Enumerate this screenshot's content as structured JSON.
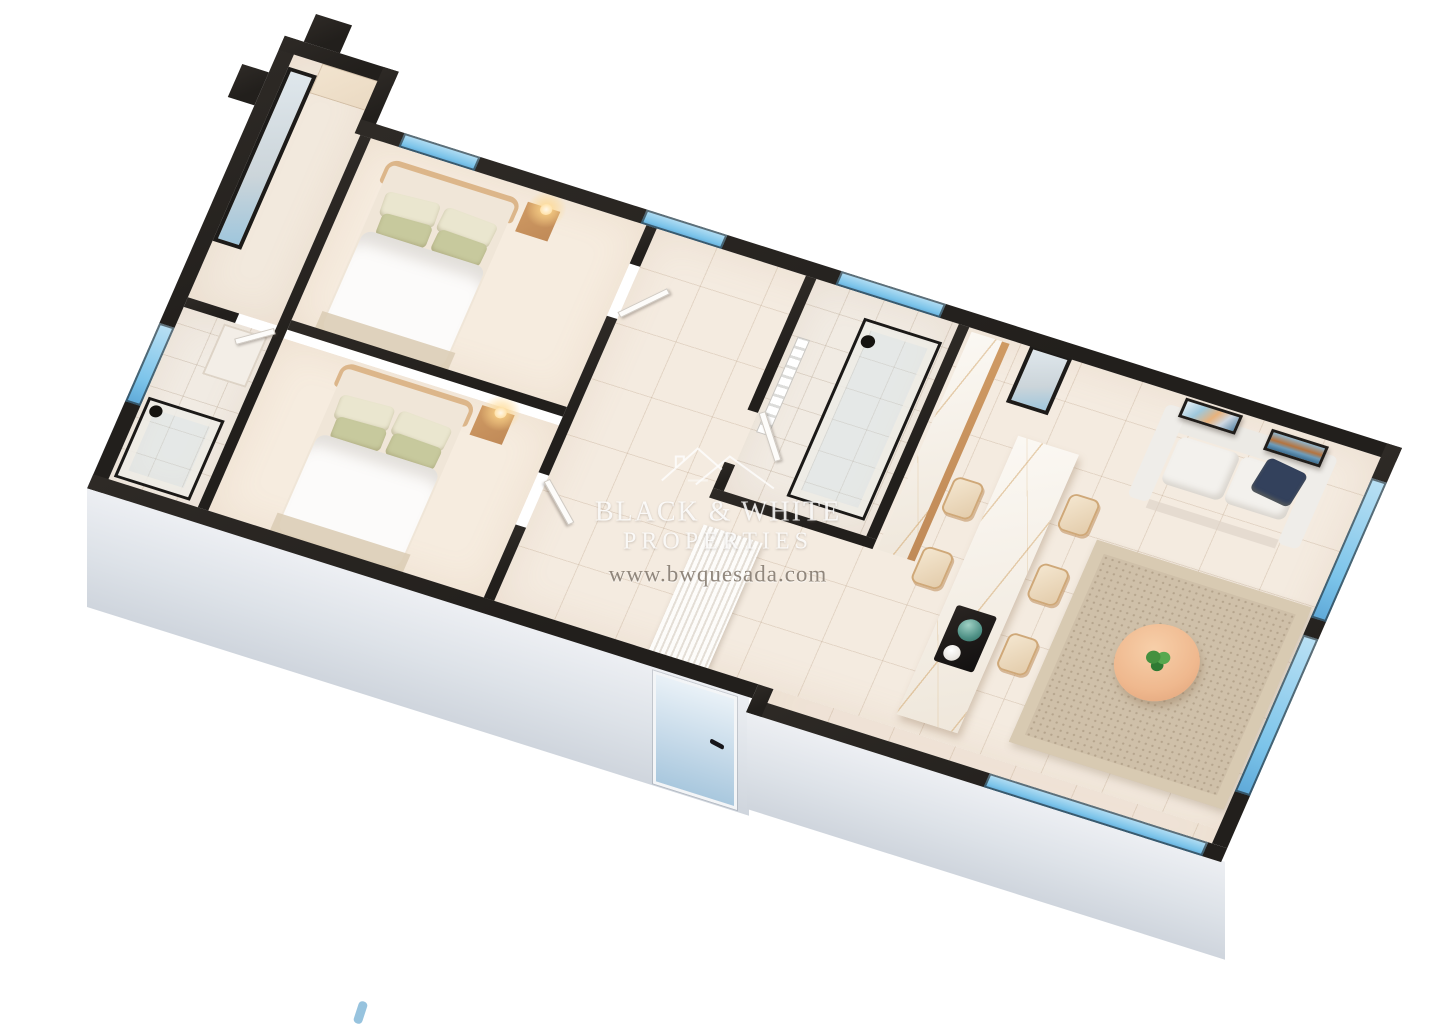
{
  "watermark": {
    "logo": "black-white-properties-roof-logo",
    "line1": "BLACK & WHITE",
    "line2": "PROPERTIES",
    "line3": "www.bwquesada.com"
  },
  "scene": {
    "type": "3d-isometric-floorplan-render",
    "regions": [
      "dressing-area",
      "ensuite-bathroom",
      "bedroom-1",
      "bedroom-2",
      "hall-corridor",
      "bathroom-2",
      "entrance-hall",
      "kitchen",
      "living-dining-room",
      "terrace-glazing"
    ]
  },
  "colors": {
    "wall_cut": "#221f1c",
    "exterior_face": "#e3e7ec",
    "floor_tile": "#f4ebe0",
    "floor_bedroom": "#f6ecdf",
    "floor_bath": "#f1ebe3",
    "marble": "#f6f0e8",
    "wood": "#c08a58",
    "wood_light": "#ead9c2",
    "headboard": "#dcb68a",
    "pillow_green": "#c7c99d",
    "pillow_cream": "#eae6cf",
    "duvet": "#fcfbfa",
    "sofa": "#f3f1ed",
    "navy_pillow": "#33415c",
    "rug": "#cfc0a9",
    "carpet": "#dbcdb6",
    "table_wood": "#efb88e",
    "plant_green": "#44903f",
    "globe_teal": "#4f9186",
    "sky_blue": "#7cc4ea",
    "mirror_glass": "#ccd5da",
    "door_blue": "#cfe0ee"
  }
}
